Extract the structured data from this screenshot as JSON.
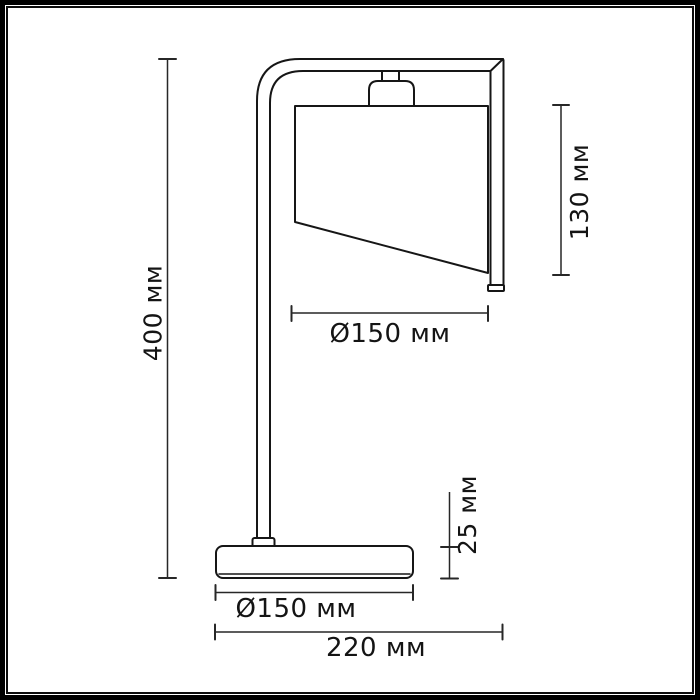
{
  "figure": {
    "kind": "technical dimension drawing",
    "subject": "table lamp with curved arm, trapezoid shade and round base",
    "background_color": "#ffffff",
    "frame_color": "#000000",
    "line_color": "#161616"
  },
  "dimensions": {
    "total_height": {
      "label": "400 мм",
      "orientation": "vertical-left"
    },
    "shade_height": {
      "label": "130 мм",
      "orientation": "vertical-right"
    },
    "shade_diameter": {
      "label": "Ø150 мм",
      "orientation": "horizontal"
    },
    "base_height": {
      "label": "25 мм",
      "orientation": "vertical-right"
    },
    "base_diameter": {
      "label": "Ø150 мм",
      "orientation": "horizontal"
    },
    "total_depth": {
      "label": "220 мм",
      "orientation": "horizontal"
    }
  }
}
